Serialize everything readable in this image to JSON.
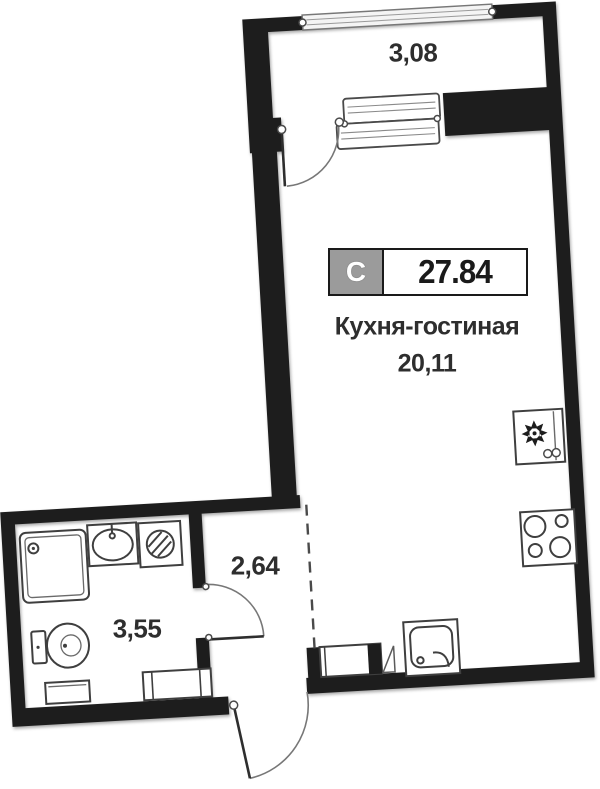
{
  "plan": {
    "badge": {
      "letter": "С",
      "value": "27.84"
    },
    "rooms": [
      {
        "id": "balcony",
        "name": "",
        "area": "3,08"
      },
      {
        "id": "kitchen-living",
        "name": "Кухня-гостиная",
        "area": "20,11"
      },
      {
        "id": "hallway",
        "name": "",
        "area": "2,64"
      },
      {
        "id": "bathroom",
        "name": "",
        "area": "3,55"
      }
    ],
    "fixtures": [
      "window",
      "balcony-door-icon",
      "fridge-icon",
      "snowflake-icon",
      "stove-icon",
      "kitchen-sink-icon",
      "kitchen-counter",
      "shower-icon",
      "sink-icon",
      "washing-machine-icon",
      "toilet-icon",
      "cabinet",
      "bathroom-door-icon",
      "entrance-door-icon"
    ],
    "colors": {
      "wall": "#1d1d1d",
      "badge_gray": "#9b9b9b",
      "text": "#2e2e2e",
      "outline": "#3f3f3f",
      "background": "#ffffff"
    }
  }
}
